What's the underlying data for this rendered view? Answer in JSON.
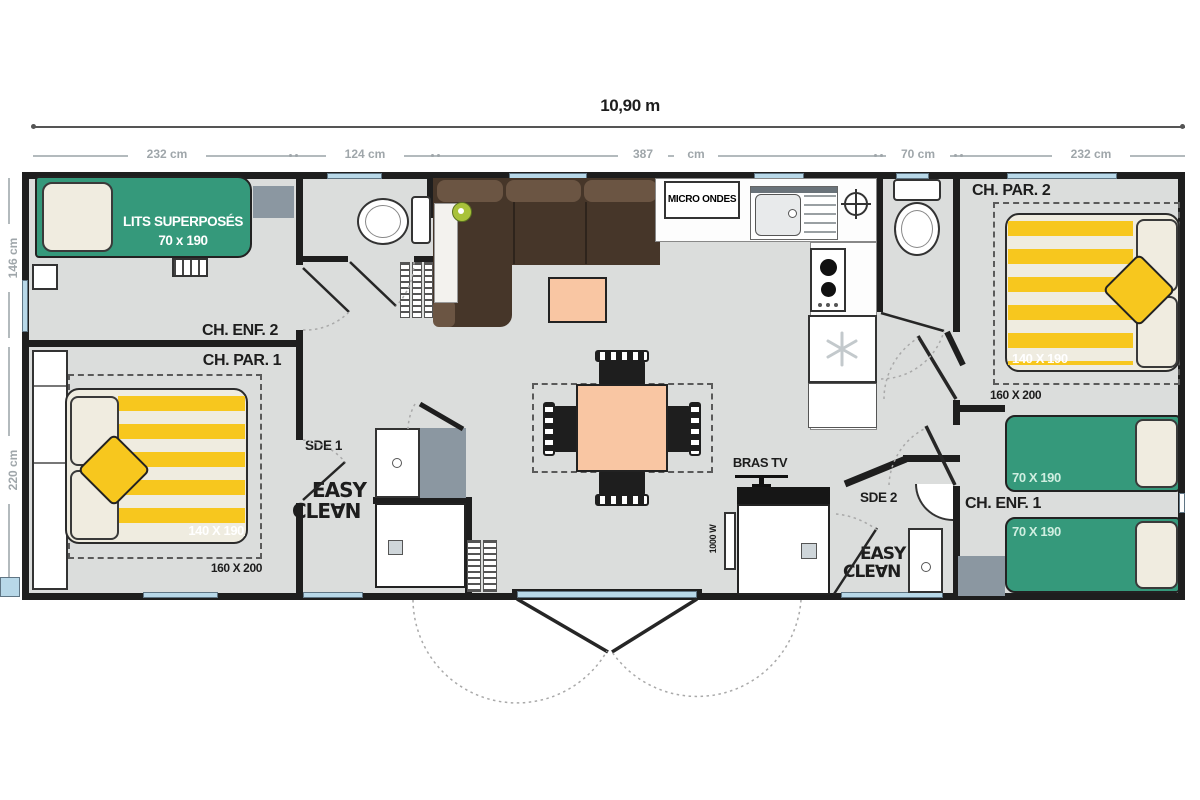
{
  "title": "10,90 m",
  "dimensions": {
    "segments": [
      "232 cm",
      "124 cm",
      "387",
      "cm",
      "70 cm",
      "232 cm"
    ],
    "left": [
      "146 cm",
      "220 cm"
    ]
  },
  "rooms": {
    "ch_enf_2": "CH. ENF. 2",
    "ch_par_1": "CH. PAR. 1",
    "ch_par_2": "CH. PAR. 2",
    "ch_enf_1": "CH. ENF. 1",
    "sde_1": "SDE 1",
    "sde_2": "SDE 2"
  },
  "furniture": {
    "bunk_label": "LITS SUPERPOSÉS",
    "bunk_size": "70 x 190",
    "double_bed_size": "140 X 190",
    "double_bed_base": "160 X 200",
    "single_bed_size": "70 X 190",
    "microwave": "MICRO ONDES",
    "tv_bracket": "BRAS TV",
    "heater": "1000 W",
    "easy_clean": {
      "line1": "EASY",
      "line2": "CLE∀N"
    }
  },
  "colors": {
    "wall": "#1e1e1e",
    "floor": "#dbdddc",
    "accent_green": "#35997b",
    "accent_yellow": "#f7c71e",
    "accent_peach": "#f9c6a3",
    "sofa_brown": "#463629",
    "window_blue": "#b8d8e8"
  }
}
